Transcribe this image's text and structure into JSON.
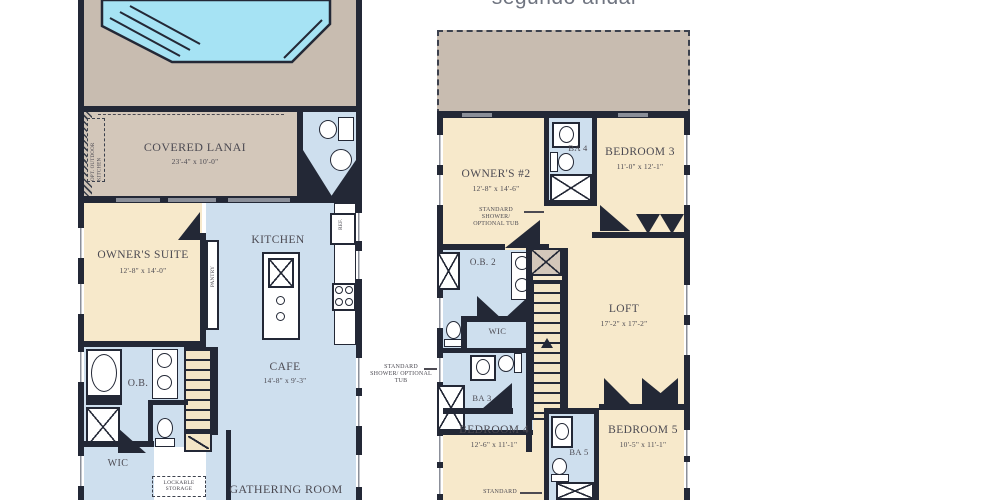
{
  "title": "segundo andar",
  "floor1": {
    "covered_lanai": {
      "label": "COVERED LANAI",
      "dims": "23'-4\" x 10'-0\""
    },
    "opt_outdoor_kitchen": "OPT. OUTDOOR KITCHEN",
    "owners_suite": {
      "label": "OWNER'S SUITE",
      "dims": "12'-8\" x 14'-0\""
    },
    "kitchen": "KITCHEN",
    "pantry": "PANTRY",
    "ref": "REF.",
    "owners_bath": "O.B.",
    "wic": "WIC",
    "cafe": {
      "label": "CAFE",
      "dims": "14'-8\" x 9'-3\""
    },
    "gathering_room": "GATHERING ROOM",
    "lockable_storage": "LOCKABLE STORAGE"
  },
  "floor2": {
    "owners_2": {
      "label": "OWNER'S #2",
      "dims": "12'-8\" x 14'-6\""
    },
    "ba4": "BA 4",
    "bedroom3": {
      "label": "BEDROOM 3",
      "dims": "11'-0\" x 12'-1\""
    },
    "shower_callout_top": "STANDARD SHOWER/ OPTIONAL TUB",
    "ob2": "O.B. 2",
    "wic": "WIC",
    "ba3": "BA 3",
    "shower_callout_left": "STANDARD SHOWER/ OPTIONAL TUB",
    "loft": {
      "label": "LOFT",
      "dims": "17'-2\" x 17'-2\""
    },
    "bedroom4": {
      "label": "BEDROOM 4",
      "dims": "12'-6\" x 11'-1\""
    },
    "ba5": "BA 5",
    "bedroom5": {
      "label": "BEDROOM 5",
      "dims": "10'-5\" x 11'-1\""
    },
    "down": "DN",
    "shower_callout_bottom": "STANDARD"
  },
  "colors": {
    "wall": "#232836",
    "room_tan": "#f7e9cb",
    "room_blue": "#cedfee",
    "deck": "#c8bcb0",
    "lanai": "#d3c7ba",
    "pool": "#a6e3f4",
    "stairs": "#f3e5c6",
    "text": "#4c4a52",
    "title": "#6f7480"
  }
}
